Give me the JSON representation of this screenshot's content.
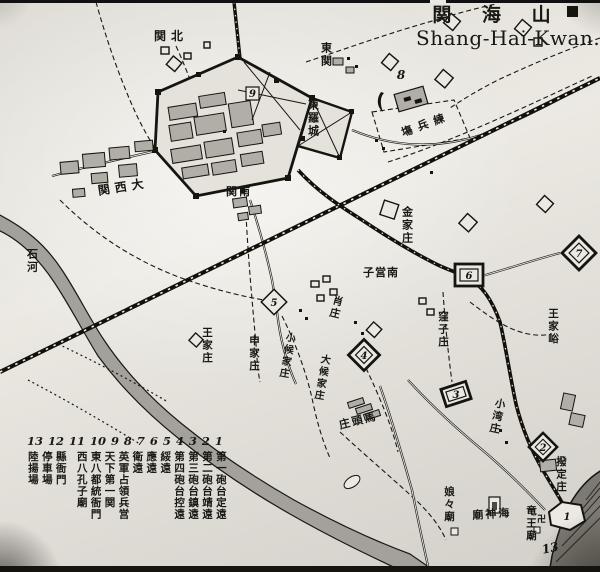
{
  "title": {
    "kanji": "関 海 山",
    "roman": "Shang-Hai-Kwan."
  },
  "legend": {
    "numbers": [
      "13",
      "12",
      "11",
      "10",
      "9",
      "8",
      "7",
      "6",
      "5",
      "4",
      "3",
      "2",
      "1"
    ],
    "items": [
      "陸揚場",
      "停車場",
      "縣衙門",
      "西八孔子廟",
      "東八都統衙門",
      "天下第一関",
      "英軍占領兵営",
      "衛遠",
      "應遠",
      "綏遠",
      "第四砲台控遠",
      "第三砲台鎮遠",
      "第二砲台靖遠",
      "第一砲台定遠"
    ]
  },
  "map_labels": {
    "north_suburb": "関北",
    "east_suburb": "東関",
    "east_outer_city": "東羅城",
    "parade_ground": "塲兵練",
    "west_suburb": "関西大",
    "south_suburb": "関南",
    "stone_river": "石河",
    "jinjia_village": "金家庄",
    "nanyingzi": "子営南",
    "xiao_village": "肖庄",
    "wazi_village": "窪子庄",
    "wangjia_valley": "王家峪",
    "wangjia_village": "王家庄",
    "shenjia_village": "申家庄",
    "small_houjia_village": "小候家庄",
    "large_houjia_village": "大候家庄",
    "matou_village": "庄頭馬",
    "xiaowan_village": "小湾庄",
    "boding_village": "撥定庄",
    "niangniang_temple": "娘々廟",
    "sea_god_temple": "廟神海",
    "dragon_king_temple": "竜王廟",
    "manji_symbol": "卍"
  },
  "markers": {
    "n1": "1",
    "n2": "2",
    "n3": "3",
    "n4": "4",
    "n5": "5",
    "n6": "6",
    "n7": "7",
    "n8": "8",
    "n9": "9",
    "n13": "13"
  },
  "colors": {
    "ink": "#181815",
    "paper": "#ebe9e2",
    "building_fill": "#b0aea6",
    "river_fill": "#a3a199",
    "sea_fill": "#7c7a72"
  }
}
